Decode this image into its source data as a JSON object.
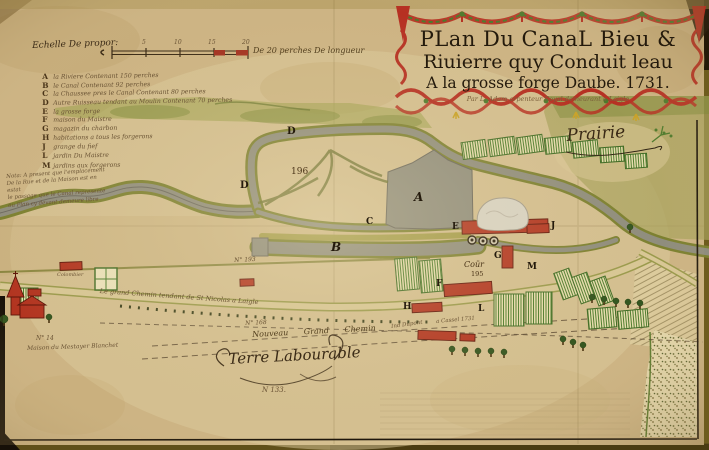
{
  "map": {
    "title_cartouche": {
      "line1": "PLan Du CanaL Bieu &",
      "line2": "Riuierre quy Conduit leau",
      "line3": "A la grosse forge Daube. 1731.",
      "byline": "Par L. Adam arpenteur Royal demeurant a Laigle"
    },
    "scale_bar": {
      "label": "Echelle De propor:",
      "ticks": [
        "5",
        "10",
        "15",
        "20"
      ],
      "caption": "De 20 perches De longueur"
    },
    "legend": {
      "entries": [
        {
          "key": "A",
          "text": "la Riviere Contenant 150 perches"
        },
        {
          "key": "B",
          "text": "le Canal Contenant 92 perches"
        },
        {
          "key": "C",
          "text": "la Chaussee pres le Canal Contenant 80 perches"
        },
        {
          "key": "D",
          "text": "Autre Ruisseau tendant au Moulin Contenant 70 perches"
        },
        {
          "key": "E",
          "text": "la grosse forge"
        },
        {
          "key": "F",
          "text": "maison du Maistre"
        },
        {
          "key": "G",
          "text": "magazin du charbon"
        },
        {
          "key": "H",
          "text": "habitations a tous les forgerons"
        },
        {
          "key": "J",
          "text": "grange du fief"
        },
        {
          "key": "L",
          "text": "jardin Du Maistre"
        },
        {
          "key": "M",
          "text": "jardins aux forgerons"
        }
      ]
    },
    "note": {
      "lines": [
        "Nota: A present que l'emplacement",
        "De la Rue et de la Maison est en estat",
        "le passage que le Canal represente",
        "au Plan cy devant demeure libre"
      ]
    },
    "labels": {
      "prairie": "Prairie",
      "parcel_196": "196",
      "cour": "Coür",
      "cour_no": "195",
      "letter_A": "A",
      "letter_B": "B",
      "letter_C": "C",
      "letter_D1": "D",
      "letter_D2": "D",
      "letter_E": "E",
      "letter_F": "F",
      "letter_G": "G",
      "letter_H": "H",
      "letter_J": "J",
      "letter_L": "L",
      "letter_M": "M",
      "road_old": "Le grand Chemin tendant de St Nicolas a Laigle",
      "road_new": "Nouveau Grand Chemin",
      "terre": "Terre Labourable",
      "terre_no": "N 133.",
      "no_168": "N° 168",
      "no_193": "N° 193",
      "no_14": "N° 14",
      "mestayer": "Maison du Mestayer Blanchet",
      "dupont": "Ind Dupont",
      "cassel": "a Cassel 1731",
      "colombier": "Colombier"
    },
    "colors": {
      "parchment": "#d3bd8e",
      "ink": "#3b2b16",
      "decor_red": "#b63022",
      "decor_green": "#4d7a2c",
      "decor_yellow": "#c9a227",
      "water_grey": "#8f8d7d",
      "bank_green": "#7c8030",
      "garden_green": "#4e7d2e",
      "meadow_olive": "#9aa04b",
      "building_red": "#b23420",
      "board_olive": "#8a7428"
    }
  }
}
